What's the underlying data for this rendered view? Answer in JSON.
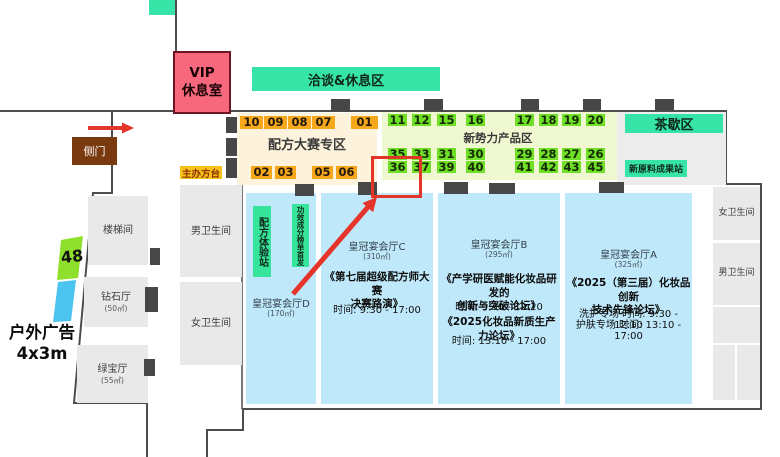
{
  "colors": {
    "teal_accent": "#36e4a7",
    "orange_booth": "#f6a71b",
    "green_booth": "#70df27",
    "cream_zone": "#fdf3dc",
    "lime_zone": "#f0f8d2",
    "hall_blue": "#bfe9fa",
    "room_gray": "#e9e9e9",
    "vip_pink": "#f7687c",
    "side_door_brown": "#7a3a10",
    "organizer_gold": "#f6c21a",
    "highlight_red": "#e5352b",
    "ad_green": "#8fe02c",
    "ad_blue": "#4cc4f0",
    "wall_gray": "#4d4d4d"
  },
  "outside": {
    "vip_line1": "VIP",
    "vip_line2": "休息室",
    "side_door": "侧门",
    "ad_number": "48",
    "ad_line1": "户外广告",
    "ad_line2": "4x3m"
  },
  "zones": {
    "lounge": "洽谈&休息区",
    "tea_break": "茶歇区",
    "raw_material_station": "新原料成果站",
    "organizer_desk": "主办方台",
    "formula_contest_zone": "配方大赛专区",
    "new_force_zone": "新势力产品区",
    "formula_experience_station": "配方体验站",
    "efficacy_ranking_station": "功效成分榜单首发"
  },
  "rooms": {
    "stairwell": "楼梯间",
    "diamond_hall": "钻石厅",
    "diamond_area": "(50㎡)",
    "emerald_hall": "绿宝厅",
    "emerald_area": "(55㎡)",
    "mens_room_left": "男卫生间",
    "womens_room_left": "女卫生间",
    "womens_room_right": "女卫生间",
    "mens_room_right": "男卫生间"
  },
  "booths": {
    "orange_row1": [
      "10",
      "09",
      "08",
      "07",
      "01"
    ],
    "orange_row2": [
      "02",
      "03",
      "05",
      "06"
    ],
    "green_row1": [
      "11",
      "12",
      "15",
      "16",
      "17",
      "18",
      "19",
      "20"
    ],
    "green_row2": [
      "35",
      "33",
      "31",
      "30",
      "29",
      "28",
      "27",
      "26"
    ],
    "green_row3": [
      "36",
      "37",
      "39",
      "40",
      "41",
      "42",
      "43",
      "45"
    ],
    "highlighted_booth": "36"
  },
  "halls": {
    "d": {
      "name": "皇冠宴会厅D",
      "area": "(170㎡)"
    },
    "c": {
      "name": "皇冠宴会厅C",
      "area": "(310㎡)",
      "event1_title": "《第七届超级配方师大赛\n决赛路演》",
      "event1_time": "时间: 9:30 - 17:00"
    },
    "b": {
      "name": "皇冠宴会厅B",
      "area": "(295㎡)",
      "event1_title": "《产学研医赋能化妆品研发的\n创新与突破论坛》",
      "event1_time": "时间: 9:30 - 12:10",
      "event2_title": "《2025化妆品新质生产力论坛》",
      "event2_time": "时间: 13:10 - 17:00"
    },
    "a": {
      "name": "皇冠宴会厅A",
      "area": "(325㎡)",
      "event1_title": "《2025（第三届）化妆品创新\n技术先锋论坛》",
      "event1_time": "洗护专场 时间: 9:30 - 12:10",
      "event2_time": "护肤专场 时间: 13:10 - 17:00"
    }
  }
}
